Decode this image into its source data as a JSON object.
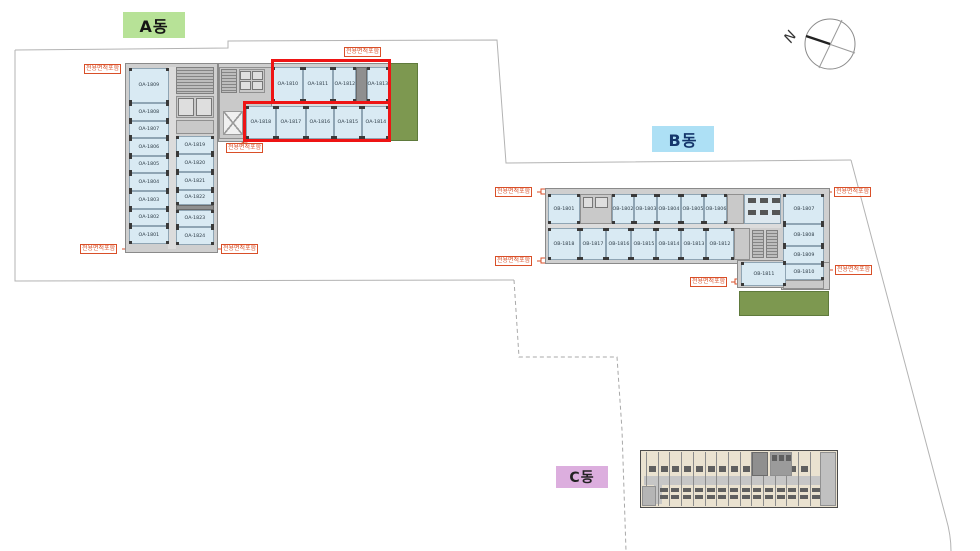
{
  "site": {
    "compass_label": "N",
    "area_tag": "전용면적포함",
    "colors": {
      "highlight_red": "#ee1414",
      "tag_red": "#d94f28",
      "room_fill": "#d9eaf3",
      "grass_green": "#7d9850",
      "label_a_bg": "#b7e297",
      "label_b_bg": "#ade0f5",
      "label_c_bg": "#dcaede"
    }
  },
  "buildings": {
    "a": {
      "label": "A동",
      "left_rooms": [
        "OA-1809",
        "OA-1808",
        "OA-1807",
        "OA-1806",
        "OA-1805",
        "OA-1804",
        "OA-1803",
        "OA-1802",
        "OA-1801"
      ],
      "inner_rooms": [
        "OA-1819",
        "OA-1820",
        "OA-1821",
        "OA-1822",
        "OA-1823",
        "OA-1824"
      ],
      "wing_top_rooms": [
        "OA-1810",
        "OA-1811",
        "OA-1812",
        "OA-1813"
      ],
      "wing_bottom_rooms": [
        "OA-1818",
        "OA-1817",
        "OA-1816",
        "OA-1815",
        "OA-1814"
      ]
    },
    "b": {
      "label": "B동",
      "top_rooms": [
        "OB-1801",
        "OB-1802",
        "OB-1803",
        "OB-1804",
        "OB-1805",
        "OB-1806"
      ],
      "bottom_rooms": [
        "OB-1818",
        "OB-1817",
        "OB-1816",
        "OB-1815",
        "OB-1814",
        "OB-1813",
        "OB-1812"
      ],
      "right_rooms": [
        "OB-1807",
        "OB-1808",
        "OB-1809",
        "OB-1810"
      ],
      "annex_room": "OB-1811"
    },
    "c": {
      "label": "C동"
    }
  }
}
